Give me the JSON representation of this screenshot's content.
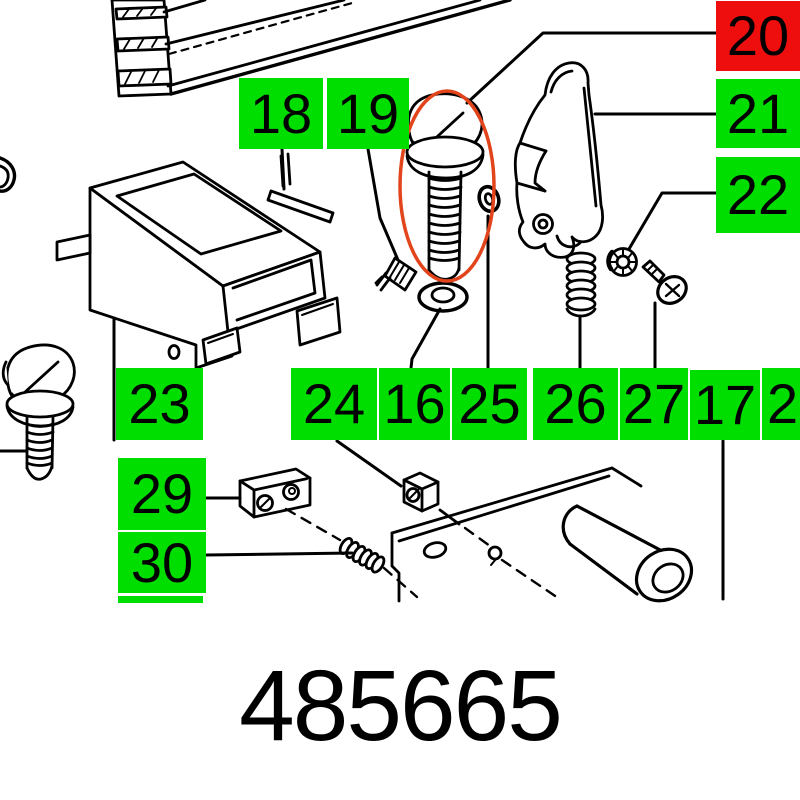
{
  "part_number": "485665",
  "labels": {
    "l16": "16",
    "l17": "17",
    "l18": "18",
    "l19": "19",
    "l20": "20",
    "l21": "21",
    "l22": "22",
    "l23": "23",
    "l24": "24",
    "l25": "25",
    "l26": "26",
    "l27": "27",
    "l28": "28",
    "l29": "29",
    "l30": "30"
  },
  "colors": {
    "highlight": "#00de00",
    "highlight_selected": "#ee0e0e",
    "line": "#000000",
    "ellipse_marker": "#e2441c",
    "background": "#ffffff"
  }
}
